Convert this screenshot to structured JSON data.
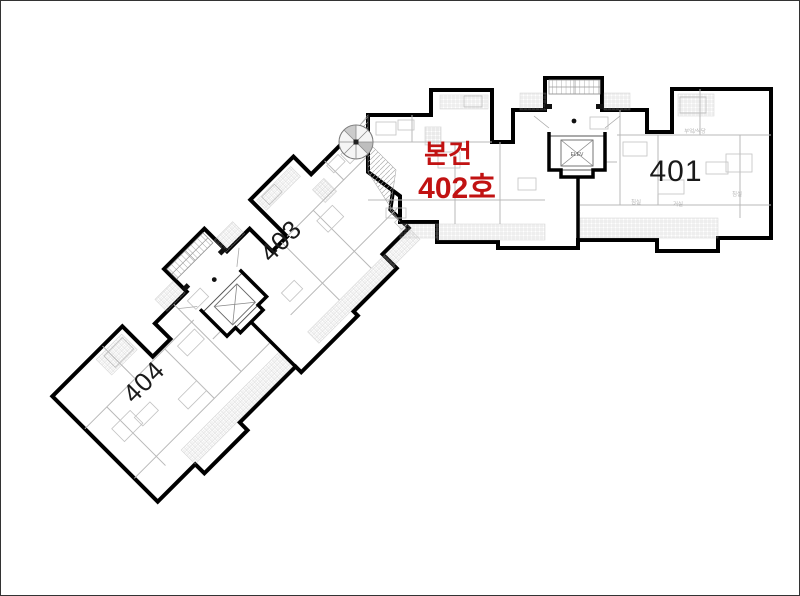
{
  "canvas": {
    "width": 800,
    "height": 596
  },
  "labels": {
    "subject": {
      "line1": "본건",
      "line2": "402호"
    },
    "unit_401": "401",
    "unit_403": "403",
    "unit_404": "404"
  },
  "room_labels": {
    "kitchen_dining": "부엌/식당",
    "bedroom_left": "침실",
    "living_room": "거실",
    "bedroom_right": "침실"
  },
  "core": {
    "elevator": "ELEV"
  },
  "colors": {
    "subject_red": "#c11212",
    "outline_black": "#000000",
    "detail_gray": "#b8b8b8",
    "background": "#ffffff"
  }
}
